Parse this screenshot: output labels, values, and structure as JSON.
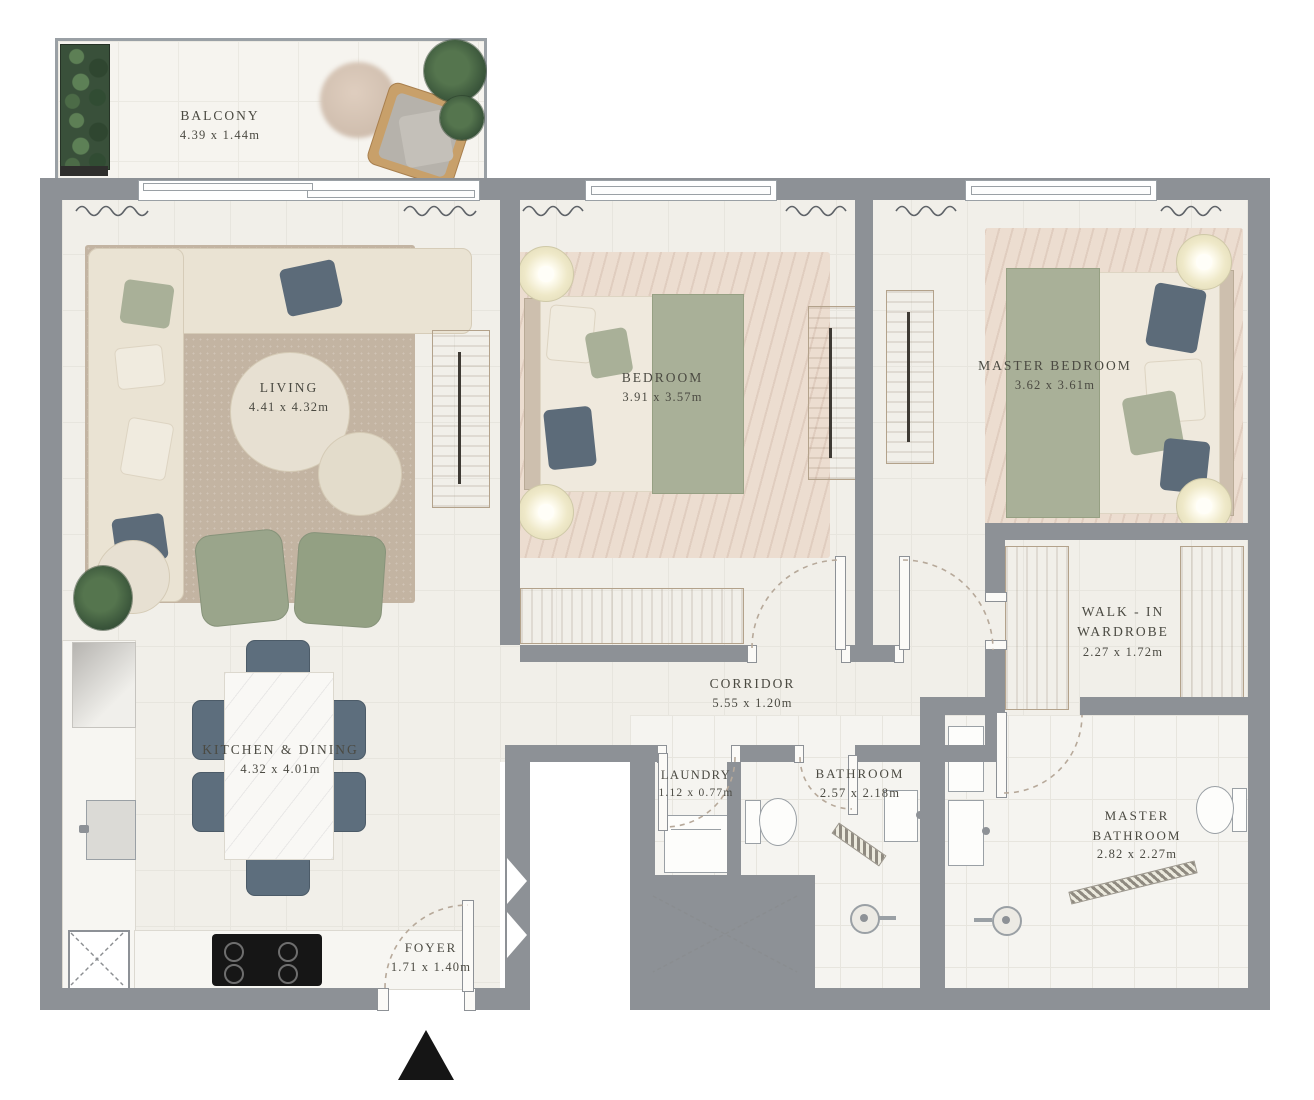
{
  "title": "Apartment Floor Plan",
  "rooms": {
    "balcony": {
      "name": "BALCONY",
      "dims": "4.39 x 1.44m"
    },
    "living": {
      "name": "LIVING",
      "dims": "4.41 x 4.32m"
    },
    "bedroom": {
      "name": "BEDROOM",
      "dims": "3.91 x 3.57m"
    },
    "master_bedroom": {
      "name": "MASTER BEDROOM",
      "dims": "3.62 x 3.61m"
    },
    "walk_in_wardrobe": {
      "name": "WALK - IN WARDROBE",
      "dims": "2.27 x 1.72m"
    },
    "corridor": {
      "name": "CORRIDOR",
      "dims": "5.55 x 1.20m"
    },
    "kitchen_dining": {
      "name": "KITCHEN & DINING",
      "dims": "4.32 x 4.01m"
    },
    "laundry": {
      "name": "LAUNDRY",
      "dims": "1.12 x 0.77m"
    },
    "bathroom": {
      "name": "BATHROOM",
      "dims": "2.57 x 2.18m"
    },
    "master_bathroom": {
      "name": "MASTER BATHROOM",
      "dims": "2.82 x 2.27m"
    },
    "foyer": {
      "name": "FOYER",
      "dims": "1.71 x 1.40m"
    }
  },
  "icons": {
    "entry_arrow": "▲",
    "shaft": "dashed-x-box",
    "shower_drain": "circle-drain"
  },
  "colors": {
    "wall": "#8d9196",
    "floor": "#f1efe9",
    "wood": "#ccb9a4",
    "sofa_cream": "#eae3d3",
    "sage_green": "#a9b098",
    "navy_pillow": "#5c6b79",
    "label_text": "#4b4a42"
  }
}
